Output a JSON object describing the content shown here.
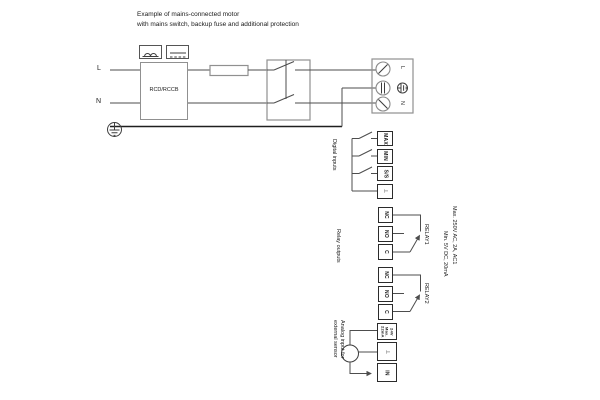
{
  "title": {
    "line1": "Example of mains-connected motor",
    "line2": "with mains switch, backup fuse and additional protection"
  },
  "mains": {
    "l_label": "L",
    "n_label": "N",
    "rcd_label": "RCD/RCCB"
  },
  "motor_terminals": {
    "l_label": "L",
    "n_label": "N"
  },
  "digital_inputs": {
    "section_label": "Digital inputs",
    "terminals": [
      "MAX",
      "MIN",
      "S/S",
      "⊥"
    ]
  },
  "relay_outputs": {
    "section_label": "Relay outputs",
    "relay1": {
      "label": "RELAY1",
      "terminals": [
        "NC",
        "NO",
        "C"
      ]
    },
    "relay2": {
      "label": "RELAY2",
      "terminals": [
        "NC",
        "NO",
        "C"
      ]
    },
    "rating_line1": "Max. 250V AC, 2A, AC1",
    "rating_line2": "Min. 5V DC, 20mA"
  },
  "analog_input": {
    "label_line1": "Analog input for",
    "label_line2": "external sensor",
    "supply_lines": [
      "24V",
      "Max.",
      "22mA"
    ],
    "ground_terminal": "⊥",
    "in_terminal": "IN"
  },
  "colors": {
    "wire": "#4d4d4d",
    "component_outline": "#909090",
    "terminal_border": "#2b2b2b",
    "ground_bus": "#1f1f1f",
    "text": "#1a1a1a",
    "background": "#ffffff"
  }
}
